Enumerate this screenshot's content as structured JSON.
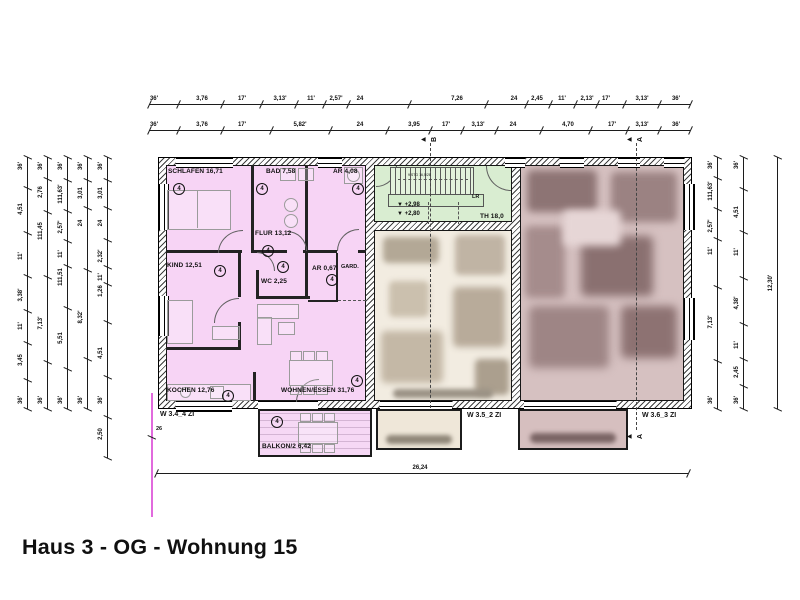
{
  "title": "Haus 3 - OG - Wohnung 15",
  "units": {
    "pink_label": "W 3.4_4 ZI",
    "middle_label": "W 3.5_2 ZI",
    "right_label": "W 3.6_3 ZI",
    "unit_marker_symbol": "4"
  },
  "stairwell": {
    "name": "TH 18,0",
    "level_upper": "+2,98",
    "level_lower": "+2,80",
    "stair_note": "9 STG 16,5/28",
    "landing_label": "LR"
  },
  "colors": {
    "pink": "#f7d4f5",
    "green": "#d9edd1",
    "beige": "#f2ece1",
    "mauve": "#d6c1c1",
    "magenta_line": "#e16add"
  },
  "plan_labels": [
    {
      "t": "SCHLAFEN 16,71",
      "x": 168,
      "y": 168,
      "c": "r"
    },
    {
      "t": "BAD 7,58",
      "x": 266,
      "y": 168,
      "c": "r"
    },
    {
      "t": "AR 4,08",
      "x": 333,
      "y": 168,
      "c": "r"
    },
    {
      "t": "FLUR 13,12",
      "x": 255,
      "y": 230,
      "c": "r"
    },
    {
      "t": "KIND 12,51",
      "x": 167,
      "y": 262,
      "c": "r"
    },
    {
      "t": "WC 2,25",
      "x": 261,
      "y": 278,
      "c": "r"
    },
    {
      "t": "AR 0,67",
      "x": 312,
      "y": 265,
      "c": "r"
    },
    {
      "t": "GARD.",
      "x": 341,
      "y": 264,
      "c": "t"
    },
    {
      "t": "KOCHEN 12,76",
      "x": 167,
      "y": 387,
      "c": "r"
    },
    {
      "t": "WOHNEN/ESSEN 31,76",
      "x": 281,
      "y": 387,
      "c": "r"
    },
    {
      "t": "BALKON/2 6,42",
      "x": 262,
      "y": 443,
      "c": "r"
    },
    {
      "t": "TH 18,0",
      "x": 480,
      "y": 213,
      "c": "r"
    },
    {
      "t": "LR",
      "x": 472,
      "y": 194,
      "c": "t"
    },
    {
      "t": "9 STG 16,5/28",
      "x": 408,
      "y": 173,
      "c": "m"
    },
    {
      "t": "▼ +2,98",
      "x": 397,
      "y": 202,
      "c": "l"
    },
    {
      "t": "▼ +2,80",
      "x": 397,
      "y": 211,
      "c": "l"
    },
    {
      "t": "W 3.4_4 ZI",
      "x": 160,
      "y": 411,
      "c": "u"
    },
    {
      "t": "W 3.5_2 ZI",
      "x": 467,
      "y": 412,
      "c": "u"
    },
    {
      "t": "W 3.6_3 ZI",
      "x": 642,
      "y": 412,
      "c": "u"
    },
    {
      "t": "26",
      "x": 156,
      "y": 426,
      "c": "t"
    }
  ],
  "unit_markers": {
    "symbol": "4",
    "positions": [
      [
        173,
        183
      ],
      [
        256,
        183
      ],
      [
        352,
        183
      ],
      [
        262,
        245
      ],
      [
        214,
        265
      ],
      [
        277,
        261
      ],
      [
        326,
        274
      ],
      [
        222,
        390
      ],
      [
        351,
        375
      ],
      [
        271,
        416
      ]
    ]
  },
  "dim_chains": [
    {
      "d": "h",
      "y": 104,
      "x1": 149,
      "x2": 690,
      "labels": [
        [
          "36'",
          154
        ],
        [
          "3,76",
          202
        ],
        [
          "17'",
          242
        ],
        [
          "3,13'",
          280
        ],
        [
          "11'",
          311
        ],
        [
          "2,57'",
          336
        ],
        [
          "24",
          360
        ],
        [
          "7,26",
          457
        ],
        [
          "24",
          514
        ],
        [
          "2,45",
          537
        ],
        [
          "11'",
          562
        ],
        [
          "2,13'",
          587
        ],
        [
          "17'",
          606
        ],
        [
          "3,13'",
          642
        ],
        [
          "36'",
          676
        ]
      ]
    },
    {
      "d": "h",
      "y": 130,
      "x1": 149,
      "x2": 690,
      "labels": [
        [
          "36'",
          154
        ],
        [
          "3,76",
          202
        ],
        [
          "17'",
          242
        ],
        [
          "5,82'",
          300
        ],
        [
          "24",
          360
        ],
        [
          "3,95",
          414
        ],
        [
          "17'",
          446
        ],
        [
          "3,13'",
          478
        ],
        [
          "24",
          513
        ],
        [
          "4,70",
          568
        ],
        [
          "17'",
          612
        ],
        [
          "3,13'",
          642
        ],
        [
          "36'",
          676
        ]
      ]
    },
    {
      "d": "h",
      "y": 473,
      "x1": 156,
      "x2": 688,
      "labels": [
        [
          "26,24",
          420
        ]
      ]
    },
    {
      "d": "v",
      "x": 27,
      "y1": 157,
      "y2": 409,
      "labels": [
        [
          "36'",
          166
        ],
        [
          "4,51",
          209
        ],
        [
          "11'",
          256
        ],
        [
          "3,38'",
          295
        ],
        [
          "11'",
          326
        ],
        [
          "3,45",
          360
        ],
        [
          "36'",
          400
        ]
      ]
    },
    {
      "d": "v",
      "x": 47,
      "y1": 157,
      "y2": 409,
      "labels": [
        [
          "36'",
          166
        ],
        [
          "2,76",
          192
        ],
        [
          "111,45",
          231
        ],
        [
          "7,13'",
          323
        ],
        [
          "36'",
          400
        ]
      ]
    },
    {
      "d": "v",
      "x": 67,
      "y1": 157,
      "y2": 409,
      "labels": [
        [
          "36'",
          166
        ],
        [
          "111,63'",
          194
        ],
        [
          "2,57'",
          227
        ],
        [
          "11'",
          254
        ],
        [
          "111,51",
          277
        ],
        [
          "5,51",
          338
        ],
        [
          "36'",
          400
        ]
      ]
    },
    {
      "d": "v",
      "x": 87,
      "y1": 157,
      "y2": 409,
      "labels": [
        [
          "36'",
          166
        ],
        [
          "3,01",
          193
        ],
        [
          "24",
          223
        ],
        [
          "8,32'",
          317
        ],
        [
          "36'",
          400
        ]
      ]
    },
    {
      "d": "v",
      "x": 107,
      "y1": 157,
      "y2": 458,
      "labels": [
        [
          "36'",
          166
        ],
        [
          "3,01",
          193
        ],
        [
          "24",
          223
        ],
        [
          "2,32'",
          256
        ],
        [
          "11'",
          277
        ],
        [
          "1,26",
          291
        ],
        [
          "4,51",
          353
        ],
        [
          "36'",
          400
        ],
        [
          "2,50",
          434
        ]
      ]
    },
    {
      "d": "v",
      "x": 717,
      "y1": 157,
      "y2": 409,
      "labels": [
        [
          "36'",
          165
        ],
        [
          "111,63'",
          191
        ],
        [
          "2,57'",
          226
        ],
        [
          "11'",
          251
        ],
        [
          "7,13'",
          322
        ],
        [
          "36'",
          400
        ]
      ]
    },
    {
      "d": "v",
      "x": 743,
      "y1": 157,
      "y2": 409,
      "labels": [
        [
          "36'",
          165
        ],
        [
          "4,51",
          212
        ],
        [
          "11'",
          252
        ],
        [
          "4,38'",
          303
        ],
        [
          "11'",
          345
        ],
        [
          "2,45",
          372
        ],
        [
          "36'",
          400
        ]
      ]
    },
    {
      "d": "v",
      "x": 777,
      "y1": 157,
      "y2": 409,
      "labels": [
        [
          "12,30'",
          283
        ]
      ]
    }
  ],
  "section_markers": [
    {
      "letter": "B",
      "x": 430,
      "y1": 143,
      "y2": 408,
      "top": true,
      "bottom": false
    },
    {
      "letter": "A",
      "x": 636,
      "y1": 143,
      "y2": 430,
      "top": true,
      "bottom": true
    }
  ]
}
